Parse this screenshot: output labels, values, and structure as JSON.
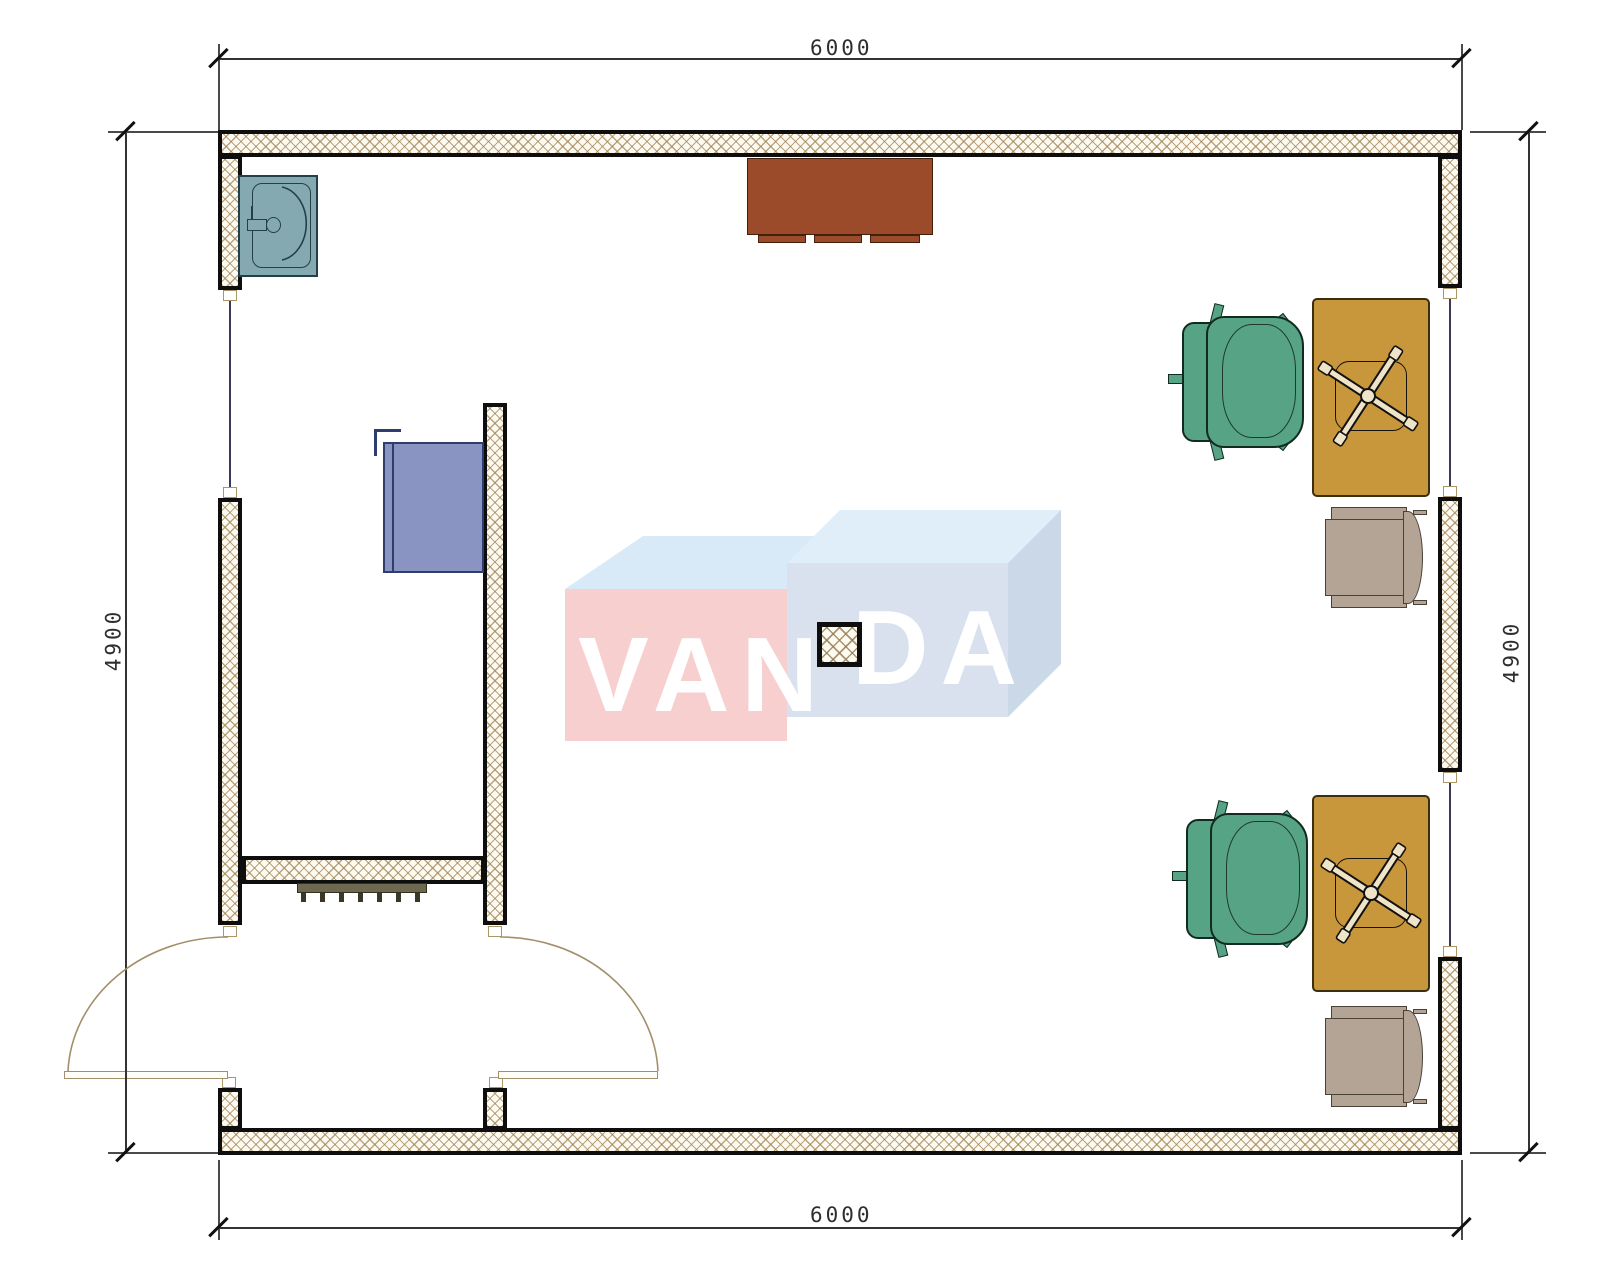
{
  "document": {
    "type": "architectural-floor-plan",
    "room_width_mm": "6000",
    "room_depth_mm": "4900"
  },
  "dimensions": {
    "top": "6000",
    "bottom": "6000",
    "left": "4900",
    "right": "4900"
  },
  "watermark": {
    "full": "VANDA",
    "left_text": "VAN",
    "right_text": "DA"
  },
  "palette": {
    "wall_hatch": "#a38658",
    "wall_edge": "#0e0e0e",
    "desk": "#c9973b",
    "office_armchair": "#57a386",
    "side_chair": "#b4a496",
    "top_cabinet": "#9b4b29",
    "blue_cabinet": "#8994c3",
    "sink": "#85a9b1",
    "door_arc": "#a3906a",
    "radiator": "#6f6850",
    "watermark_pink": "#f6caca",
    "watermark_blue": "#d4deeb",
    "dimension_line": "#333333"
  },
  "symbols": {
    "items": [
      "sink",
      "wall-cabinet",
      "blue-storage-cabinet",
      "desk",
      "task-chair-x-base",
      "office-armchair",
      "side-chair",
      "radiator",
      "column",
      "door-swing",
      "window"
    ]
  }
}
